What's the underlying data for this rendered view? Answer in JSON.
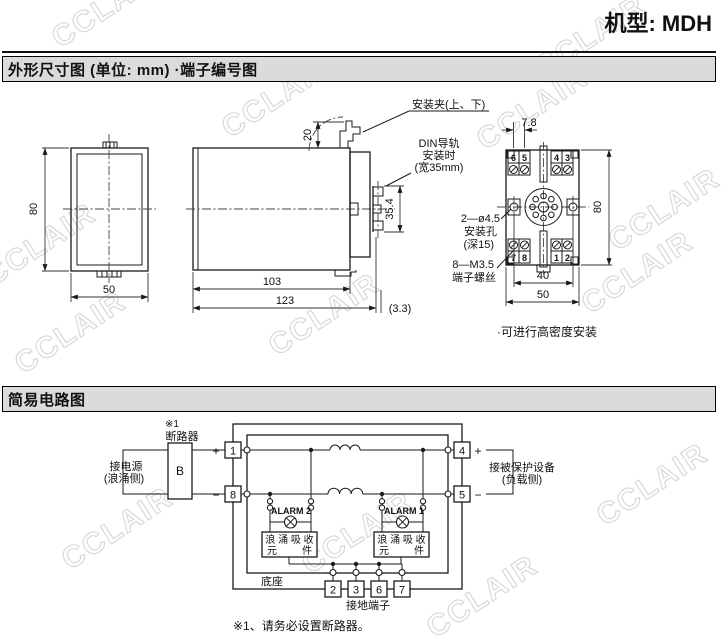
{
  "watermark": {
    "text": "CCLAIR"
  },
  "page": {
    "title": "机型: MDH"
  },
  "dim_section": {
    "header": "外形尺寸图 (单位: mm) ·端子编号图",
    "front": {
      "height": "80",
      "width": "50"
    },
    "side": {
      "clip_label": "安装夹(上、下)",
      "din_line1": "DIN导轨",
      "din_line2": "安装时",
      "din_line3": "(宽35mm)",
      "clip_height": "20",
      "rail_height": "35.4",
      "depth_body": "103",
      "depth_total": "123",
      "depth_extra": "(3.3)"
    },
    "rear": {
      "pitch": "7.8",
      "height": "80",
      "hole_span": "40",
      "width": "50",
      "terminals_top": [
        "6",
        "5",
        "4",
        "3"
      ],
      "terminals_bottom": [
        "7",
        "8",
        "1",
        "2"
      ],
      "hole_label1": "2—ø4.5",
      "hole_label2": "安装孔",
      "hole_label3": "(深15)",
      "screw_label1": "8—M3.5",
      "screw_label2": "端子螺丝",
      "note": "·可进行高密度安装"
    }
  },
  "circuit_section": {
    "header": "简易电路图",
    "ref_mark": "※1",
    "breaker": "断路器",
    "breaker_symbol": "B",
    "source_line1": "接电源",
    "source_line2": "(浪涌侧)",
    "load_line1": "接被保护设备",
    "load_line2": "(负载侧)",
    "plus": "+",
    "minus": "−",
    "t1": "1",
    "t8": "8",
    "t4": "4",
    "t5": "5",
    "ground_terminals": [
      "2",
      "3",
      "6",
      "7"
    ],
    "alarm2": "ALARM 2",
    "alarm1": "ALARM 1",
    "surge_line1": "浪 涌 吸 收",
    "surge_el_left": "元",
    "surge_el_right": "件",
    "base_label": "底座",
    "ground_label": "接地端子",
    "footnote": "※1、请务必设置断路器。"
  }
}
